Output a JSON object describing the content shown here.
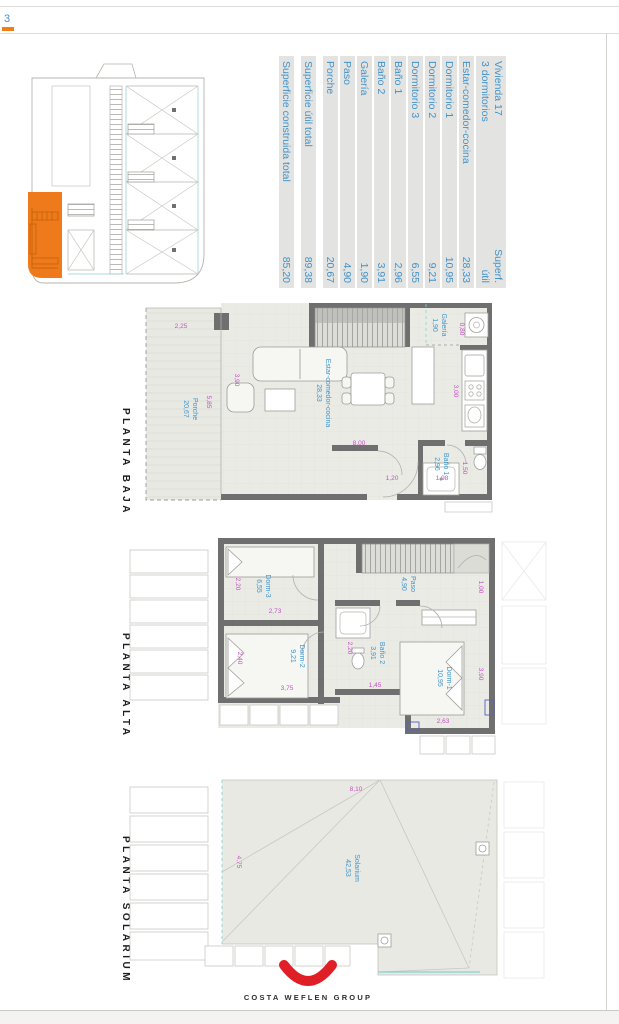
{
  "page": {
    "corner_mark": "3",
    "logo_text": "COSTA WEFLEN GROUP",
    "colors": {
      "highlight_orange": "#EE7A1C",
      "room_label_blue": "#3E92C8",
      "dimension_magenta": "#C64FC6",
      "logo_red": "#E01E25",
      "wall_gray": "#6F6F6F"
    }
  },
  "summary_table": {
    "title_line1": "Vivienda 17",
    "title_line2": "3 dormitorios",
    "column_header_line1": "Superf.",
    "column_header_line2": "útil",
    "rows": [
      {
        "label": "Estar-comedor-cocina",
        "value": "28,33"
      },
      {
        "label": "Dormitorio 1",
        "value": "10,95"
      },
      {
        "label": "Dormitorio 2",
        "value": "9,21"
      },
      {
        "label": "Dormitorio 3",
        "value": "6,55"
      },
      {
        "label": "Baño 1",
        "value": "2,96"
      },
      {
        "label": "Baño 2",
        "value": "3,91"
      },
      {
        "label": "Galería",
        "value": "1,90"
      },
      {
        "label": "Paso",
        "value": "4,90"
      },
      {
        "label": "Porche",
        "value": "20,67"
      }
    ],
    "total_util": {
      "label": "Superficie útil total",
      "value": "89,38"
    },
    "total_construida": {
      "label": "Superficie construida total",
      "value": "85,20"
    }
  },
  "plans": {
    "baja": {
      "title": "PLANTA BAJA",
      "rooms": {
        "porche": {
          "name": "Porche",
          "area": "20,67"
        },
        "estar": {
          "name": "Estar-comedor-cocina",
          "area": "28,33"
        },
        "galeria": {
          "name": "Galería",
          "area": "1,90"
        },
        "bano1": {
          "name": "Baño 1",
          "area": "2,96"
        }
      },
      "dims": {
        "porche_width": "2,25",
        "porche_depth": "5,85",
        "salon_width": "3,90",
        "salon_depth": "8,00",
        "galeria_width": "0,80",
        "cocina_depth": "3,00",
        "bano1_width": "1,50",
        "ducha_width": "1,98",
        "paso_width": "1,20"
      }
    },
    "alta": {
      "title": "PLANTA ALTA",
      "rooms": {
        "dorm3": {
          "name": "Dorm-3",
          "area": "6,55"
        },
        "dorm2": {
          "name": "Dorm-2",
          "area": "9,21"
        },
        "dorm1": {
          "name": "Dorm-1",
          "area": "10,95"
        },
        "bano2": {
          "name": "Baño 2",
          "area": "3,91"
        },
        "paso": {
          "name": "Paso",
          "area": "4,90"
        }
      },
      "dims": {
        "dorm3_width": "2,20",
        "dorm3_depth": "2,73",
        "dorm2_width": "2,40",
        "dorm2_depth": "3,75",
        "bano2_width": "2,20",
        "bano2_depth": "1,45",
        "pasillo_width": "1,00",
        "dorm1_width": "3,90",
        "dorm1_depth": "2,63"
      }
    },
    "solarium": {
      "title": "PLANTA SOLARIUM",
      "rooms": {
        "solarium": {
          "name": "Solarium",
          "area": "42,53"
        }
      },
      "dims": {
        "width": "8,10",
        "depth": "4,75"
      }
    }
  }
}
